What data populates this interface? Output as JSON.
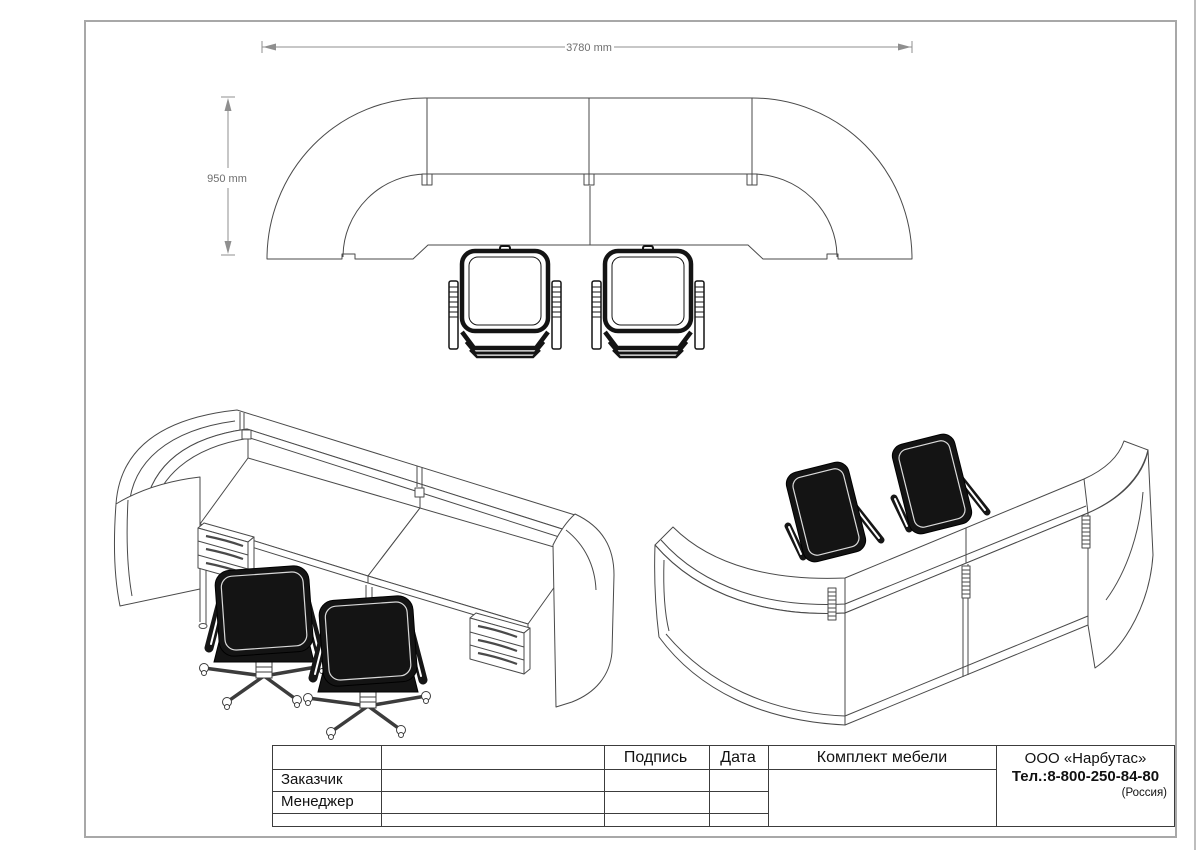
{
  "sheet": {
    "background": "#ffffff",
    "border_color": "#a8a8a8",
    "line_color": "#4a4a4a",
    "chair_color": "#141414"
  },
  "plan_view": {
    "dim_width": "3780 mm",
    "dim_height": "950 mm"
  },
  "title_block": {
    "header": {
      "signature": "Подпись",
      "date": "Дата"
    },
    "left_rows": [
      "Заказчик",
      "Менеджер"
    ],
    "product_title": "Комплект мебели",
    "company": {
      "name": "ООО «Нарбутас»",
      "phone": "Тел.:8-800-250-84-80",
      "country": "(Россия)"
    }
  }
}
